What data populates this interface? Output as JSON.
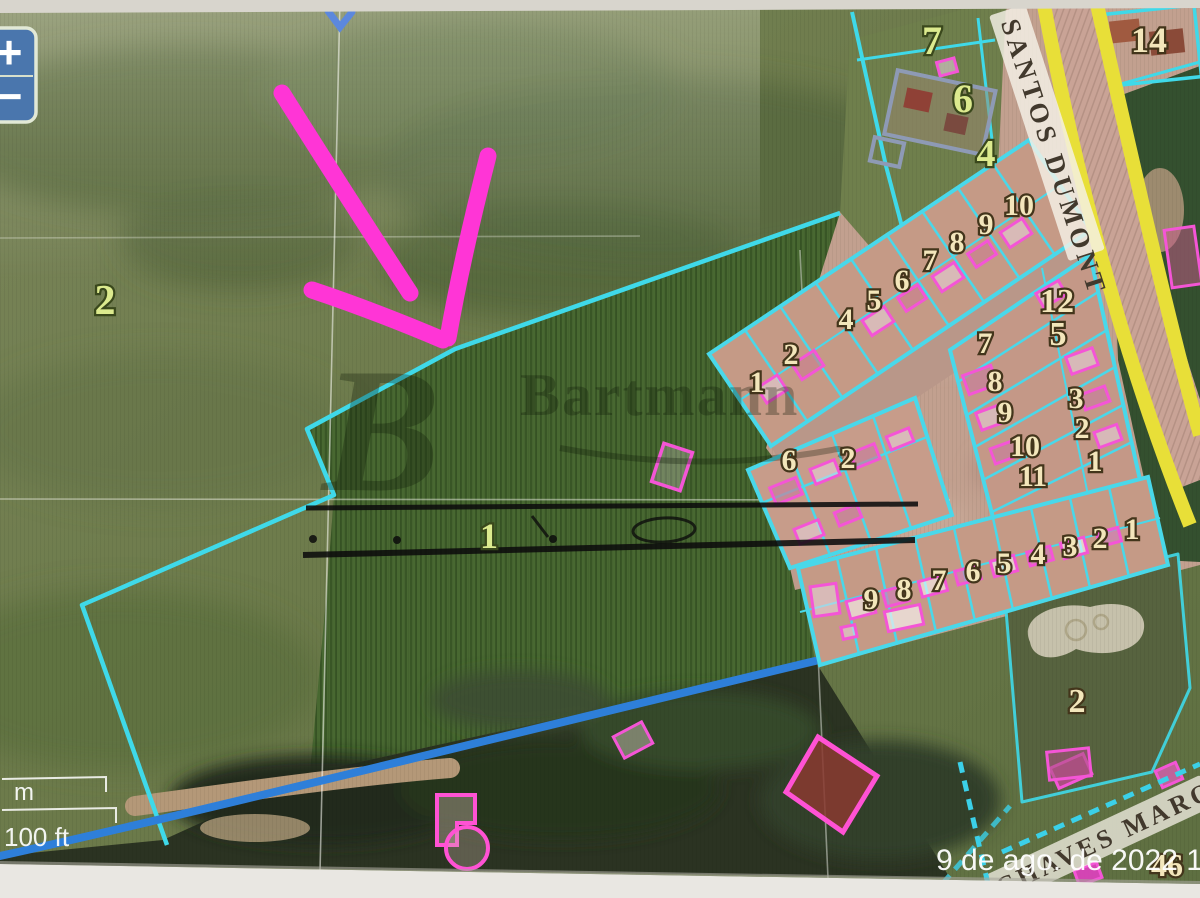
{
  "map": {
    "controls": {
      "zoom_in_label": "+",
      "zoom_out_label": "−"
    },
    "scale": {
      "metric_label": "m",
      "imperial_label": "100 ft"
    },
    "timestamp": "9 de ago. de 2022 11:1",
    "watermark": {
      "logo": "B",
      "brand": "Bartmann"
    },
    "streets": {
      "main": "SANTOS DUMONT",
      "secondary": "CHAVES MARQU"
    },
    "parcel_labels": [
      {
        "t": "2",
        "x": 105,
        "y": 314,
        "fs": 42
      },
      {
        "t": "1",
        "x": 489,
        "y": 548,
        "fs": 36
      },
      {
        "t": "7",
        "x": 932,
        "y": 54,
        "fs": 40
      },
      {
        "t": "6",
        "x": 963,
        "y": 112,
        "fs": 40
      },
      {
        "t": "4",
        "x": 986,
        "y": 166,
        "fs": 38
      }
    ],
    "lot_labels": [
      {
        "t": "14",
        "x": 1149,
        "y": 52,
        "fs": 36
      },
      {
        "t": "10",
        "x": 1019,
        "y": 215
      },
      {
        "t": "9",
        "x": 986,
        "y": 234
      },
      {
        "t": "8",
        "x": 957,
        "y": 252
      },
      {
        "t": "7",
        "x": 930,
        "y": 270
      },
      {
        "t": "6",
        "x": 902,
        "y": 290
      },
      {
        "t": "5",
        "x": 874,
        "y": 310
      },
      {
        "t": "4",
        "x": 846,
        "y": 329
      },
      {
        "t": "2",
        "x": 791,
        "y": 364
      },
      {
        "t": "1",
        "x": 757,
        "y": 392
      },
      {
        "t": "12",
        "x": 1057,
        "y": 312,
        "fs": 34
      },
      {
        "t": "5",
        "x": 1058,
        "y": 345,
        "fs": 34
      },
      {
        "t": "7",
        "x": 985,
        "y": 353
      },
      {
        "t": "8",
        "x": 995,
        "y": 391
      },
      {
        "t": "9",
        "x": 1005,
        "y": 422
      },
      {
        "t": "10",
        "x": 1025,
        "y": 456
      },
      {
        "t": "11",
        "x": 1033,
        "y": 486
      },
      {
        "t": "3",
        "x": 1076,
        "y": 408
      },
      {
        "t": "2",
        "x": 1082,
        "y": 438
      },
      {
        "t": "1",
        "x": 1095,
        "y": 471
      },
      {
        "t": "6",
        "x": 789,
        "y": 470
      },
      {
        "t": "2",
        "x": 848,
        "y": 468
      },
      {
        "t": "9",
        "x": 871,
        "y": 609
      },
      {
        "t": "8",
        "x": 904,
        "y": 599
      },
      {
        "t": "7",
        "x": 939,
        "y": 590
      },
      {
        "t": "6",
        "x": 973,
        "y": 581
      },
      {
        "t": "5",
        "x": 1004,
        "y": 573
      },
      {
        "t": "4",
        "x": 1038,
        "y": 564
      },
      {
        "t": "3",
        "x": 1070,
        "y": 556
      },
      {
        "t": "2",
        "x": 1100,
        "y": 548
      },
      {
        "t": "1",
        "x": 1132,
        "y": 539
      },
      {
        "t": "2",
        "x": 1077,
        "y": 712,
        "fs": 34
      },
      {
        "t": "46",
        "x": 1167,
        "y": 876,
        "fs": 32
      }
    ]
  }
}
